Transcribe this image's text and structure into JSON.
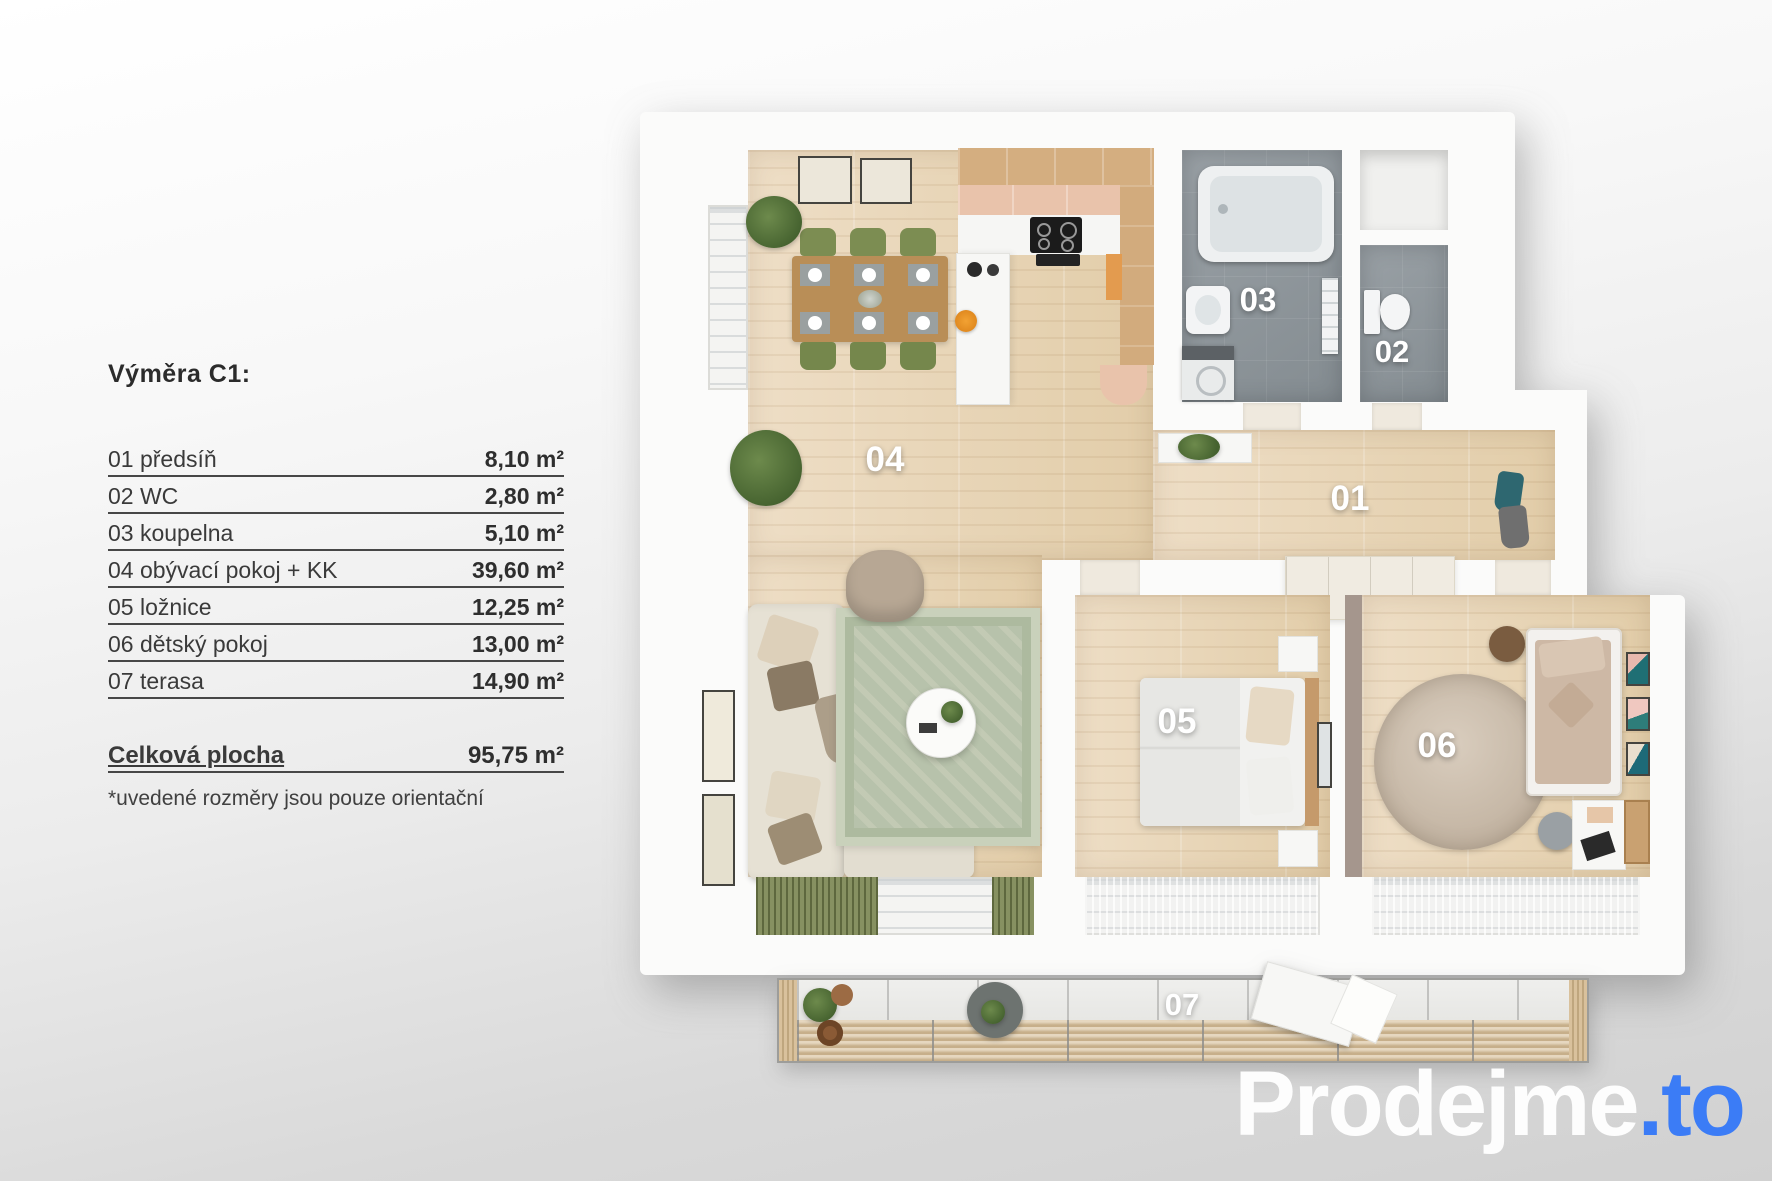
{
  "legend": {
    "title": "Výměra C1:",
    "rows": [
      {
        "label": "01 předsíň",
        "value": "8,10 m²"
      },
      {
        "label": "02 WC",
        "value": "2,80 m²"
      },
      {
        "label": "03 koupelna",
        "value": "5,10 m²"
      },
      {
        "label": "04 obývací pokoj + KK",
        "value": "39,60 m²"
      },
      {
        "label": "05 ložnice",
        "value": "12,25 m²"
      },
      {
        "label": "06 dětský pokoj",
        "value": "13,00 m²"
      },
      {
        "label": "07 terasa",
        "value": "14,90 m²"
      }
    ],
    "total": {
      "label": "Celková plocha",
      "value": "95,75 m²"
    },
    "footnote": "*uvedené rozměry jsou pouze orientační"
  },
  "plan": {
    "labels": {
      "r01": "01",
      "r02": "02",
      "r03": "03",
      "r04": "04",
      "r05": "05",
      "r06": "06",
      "r07": "07"
    }
  },
  "logo": {
    "name": "Prodejme",
    "tld": ".to",
    "accent_color": "#3b7cf6"
  }
}
